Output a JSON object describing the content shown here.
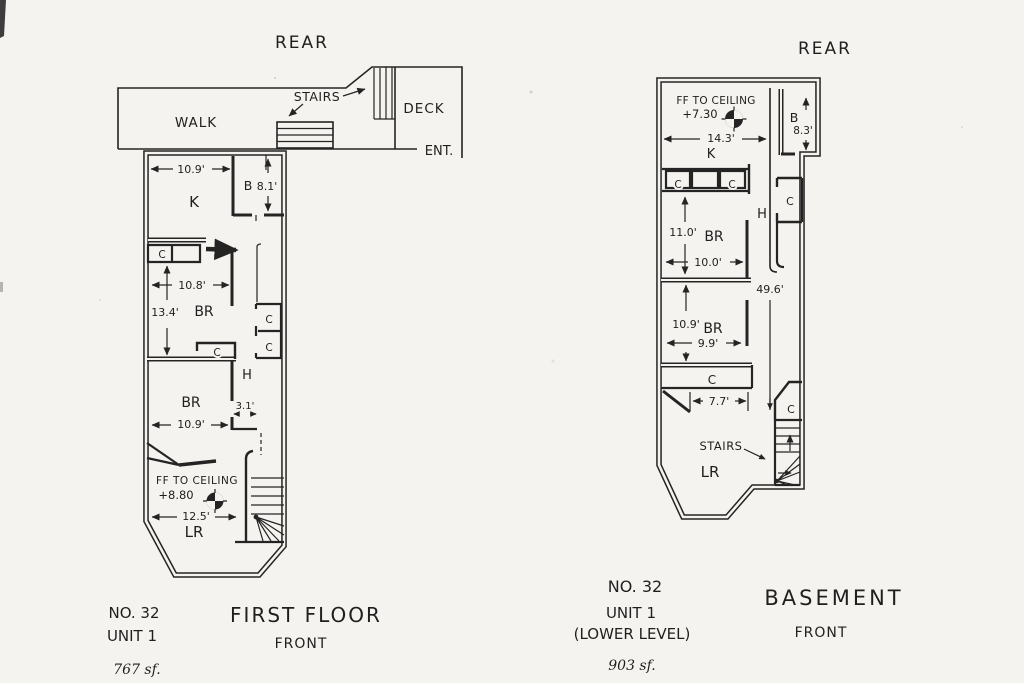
{
  "palette": {
    "paper": "#f5f3ef",
    "ink": "#1f1f1f"
  },
  "first_floor": {
    "orientation_top": "REAR",
    "exterior": {
      "walk": "WALK",
      "stairs": "STAIRS",
      "deck": "DECK",
      "entry": "ENT."
    },
    "rooms": {
      "kitchen": "K",
      "bath": "B",
      "bedroom_mid": "BR",
      "bedroom_front": "BR",
      "hall": "H",
      "living_room": "LR"
    },
    "closets": [
      "C",
      "C",
      "C",
      "C"
    ],
    "dimensions": {
      "kitchen_width": "10.9'",
      "bath_depth": "8.1'",
      "bedroom_mid_width": "10.8'",
      "bedroom_mid_depth": "13.4'",
      "bedroom_front_width": "10.9'",
      "hall_width": "3.1'",
      "living_width": "12.5'"
    },
    "ceiling_note": {
      "line1": "FF TO CEILING",
      "line2": "+8.80"
    },
    "footer": {
      "number": "NO. 32",
      "unit": "UNIT 1",
      "area": "767 sf.",
      "title": "FIRST FLOOR",
      "subtitle": "FRONT"
    }
  },
  "basement": {
    "orientation_top": "REAR",
    "stairs_label": "STAIRS",
    "rooms": {
      "kitchen": "K",
      "bath": "B",
      "bedroom_mid": "BR",
      "bedroom_front": "BR",
      "hall": "H",
      "living_room": "LR"
    },
    "closets": [
      "C",
      "C",
      "C",
      "C",
      "C"
    ],
    "dimensions": {
      "kitchen_width": "14.3'",
      "bath_depth": "8.3'",
      "bedroom_mid_depth": "11.0'",
      "bedroom_mid_width": "10.0'",
      "overall_depth": "49.6'",
      "bedroom_front_depth": "10.9'",
      "bedroom_front_width": "9.9'",
      "closet_width": "7.7'"
    },
    "ceiling_note": {
      "line1": "FF TO CEILING",
      "line2": "+7.30"
    },
    "footer": {
      "number": "NO. 32",
      "unit": "UNIT 1",
      "level": "(LOWER LEVEL)",
      "area": "903 sf.",
      "title": "BASEMENT",
      "subtitle": "FRONT"
    }
  }
}
